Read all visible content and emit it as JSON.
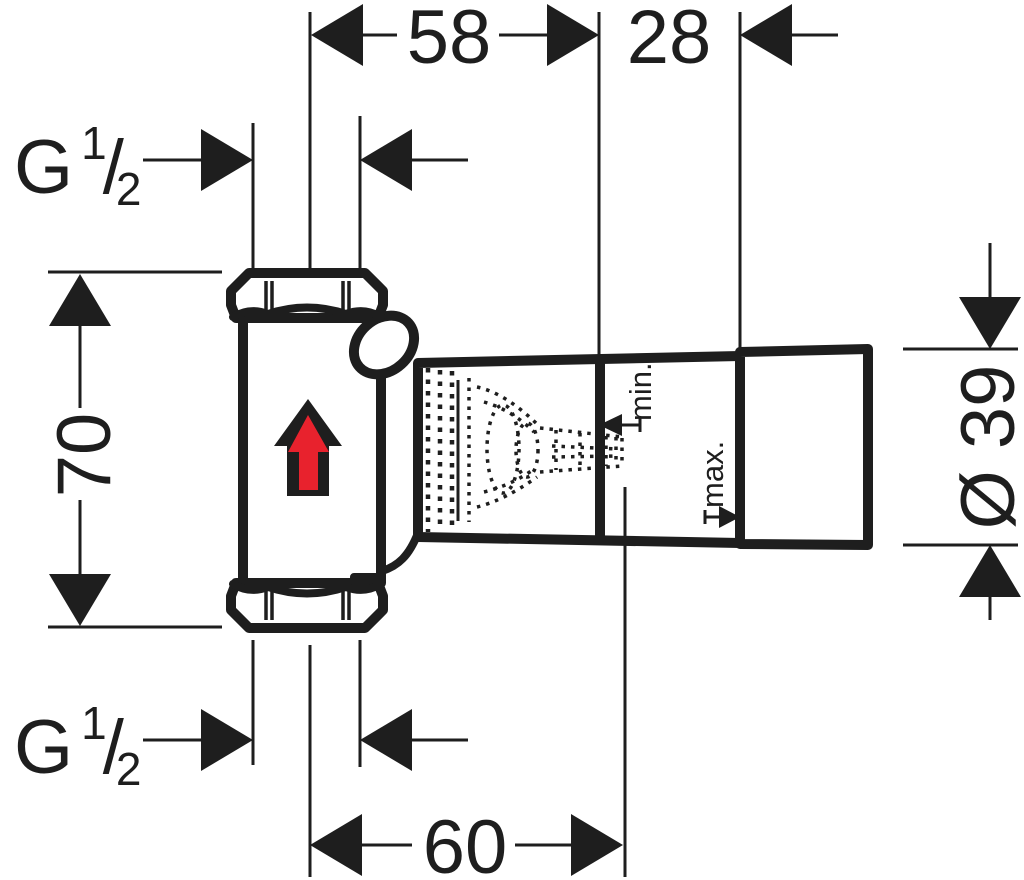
{
  "drawing": {
    "background_color": "#ffffff",
    "line_color": "#1e1e1e",
    "flow_arrow_color": "#e8222d"
  },
  "icons": {
    "flow_direction_arrow": "upward-arrow"
  },
  "dimensions": {
    "top_width": "58",
    "top_depth": "28",
    "height": "70",
    "spindle_depth": "60",
    "cap_diameter": "Ø 39",
    "plaster_depth_min": "min.",
    "plaster_depth_max": "max.",
    "thread_top": {
      "letter": "G",
      "numerator": "1",
      "slash": "/",
      "denominator": "2"
    },
    "thread_bottom": {
      "letter": "G",
      "numerator": "1",
      "slash": "/",
      "denominator": "2"
    }
  }
}
